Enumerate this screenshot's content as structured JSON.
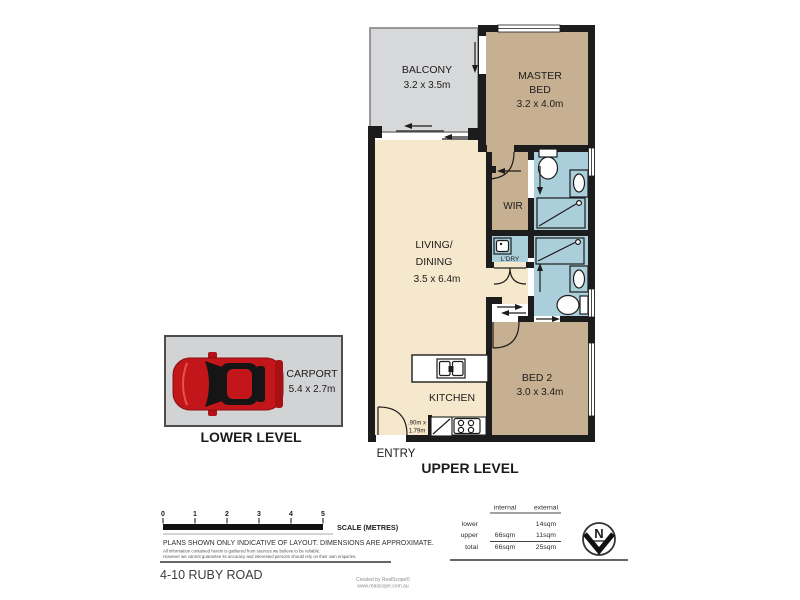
{
  "colors": {
    "wall": "#1c1c1c",
    "room_tan": "#c7b091",
    "room_cream": "#f6e8cc",
    "wet_area_blue": "#aacfdb",
    "balcony_gray": "#d7d8da",
    "carport_gray": "#d2d3d5",
    "car_red": "#c3161b"
  },
  "rooms": {
    "balcony": {
      "label": "BALCONY",
      "dims": "3.2 x 3.5m"
    },
    "master_bed": {
      "label1": "MASTER",
      "label2": "BED",
      "dims": "3.2 x 4.0m"
    },
    "wir": {
      "label": "WIR"
    },
    "living_dining": {
      "label1": "LIVING/",
      "label2": "DINING",
      "dims": "3.5 x 6.4m"
    },
    "laundry": {
      "label": "L'DRY"
    },
    "kitchen": {
      "label": "KITCHEN"
    },
    "bed2": {
      "label": "BED 2",
      "dims": "3.0 x 3.4m"
    },
    "pantry": {
      "dims1": ".90m x",
      "dims2": "1.79m"
    },
    "carport": {
      "label": "CARPORT",
      "dims": "5.4 x 2.7m"
    }
  },
  "levels": {
    "entry": "ENTRY",
    "upper": "UPPER LEVEL",
    "lower": "LOWER LEVEL"
  },
  "scale_bar": {
    "ticks": [
      "0",
      "1",
      "2",
      "3",
      "4",
      "5"
    ],
    "label": "SCALE (METRES)"
  },
  "disclaimer": {
    "line1": "PLANS SHOWN ONLY INDICATIVE OF LAYOUT.  DIMENSIONS ARE APPROXIMATE.",
    "line2": "All information contained herein is gathered from sources we believe to be reliable.",
    "line3": "However we cannot guarantee its accuracy and interested persons should rely on their own enquiries."
  },
  "area_table": {
    "headers": {
      "internal": "internal",
      "external": "external"
    },
    "rows": [
      {
        "label": "lower",
        "internal": "",
        "external": "14sqm"
      },
      {
        "label": "upper",
        "internal": "66sqm",
        "external": "11sqm"
      },
      {
        "label": "total",
        "internal": "66sqm",
        "external": "25sqm"
      }
    ]
  },
  "compass": {
    "label": "N"
  },
  "footer": {
    "address": "4-10 RUBY ROAD",
    "credit1": "Created by RealScope©",
    "credit2": "www.realscope.com.au"
  }
}
